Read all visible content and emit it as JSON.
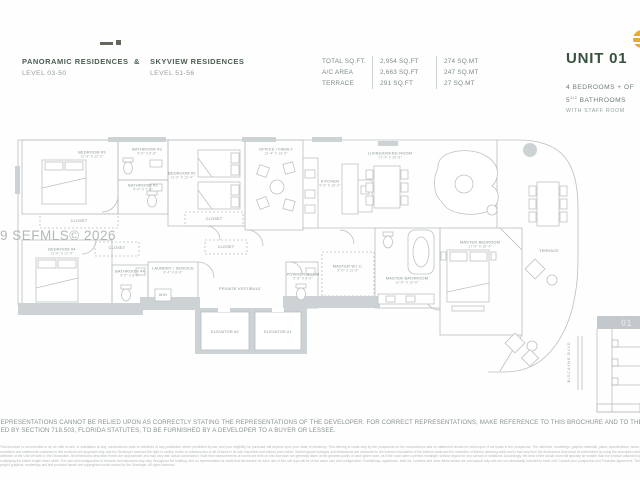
{
  "header": {
    "left": {
      "title1": "PANORAMIC RESIDENCES",
      "amp": "&",
      "title2": "SKYVIEW RESIDENCES",
      "level1": "LEVEL 03-50",
      "level2": "LEVEL 51-56"
    },
    "area_table": {
      "rows": [
        {
          "label": "TOTAL SQ.FT.",
          "sqft": "2,954 SQ.FT",
          "sqmt": "274 SQ.MT"
        },
        {
          "label": "A/C AREA",
          "sqft": "2,663 SQ.FT",
          "sqmt": "247 SQ.MT"
        },
        {
          "label": "TERRACE",
          "sqft": "291 SQ.FT",
          "sqmt": "27 SQ.MT"
        }
      ]
    },
    "unit": {
      "title": "UNIT 01",
      "bedrooms": "4 BEDROOMS + OF",
      "bath_number": "5",
      "bath_fraction": "1/2",
      "bath_label": " BATHROOMS",
      "staff": "WITH STAFF ROOM"
    }
  },
  "watermark": "49 SEFMLS© 2026",
  "plan": {
    "rooms": [
      {
        "name": "BEDROOM #3",
        "dims": "11'-4″ x 12'-0″"
      },
      {
        "name": "BATHROOM #3",
        "dims": "5'-0″ x 8'-6″"
      },
      {
        "name": "CLOSET"
      },
      {
        "name": "BATHROOM #2",
        "dims": "5'-0″ x 7'-6″"
      },
      {
        "name": "BEDROOM #2",
        "dims": "11'-0″ x 12'-4″"
      },
      {
        "name": "CLOSET"
      },
      {
        "name": "OFFICE / FAMILY",
        "dims": "12'-4″ x 13'-6″"
      },
      {
        "name": "KITCHEN",
        "dims": "9'-6″ x 16'-0″"
      },
      {
        "name": "LIVING/DINING ROOM",
        "dims": "17'-4″ x 20'-6″"
      },
      {
        "name": "BEDROOM #4",
        "dims": "11'-0″ x 12'-0″"
      },
      {
        "name": "CLOSET"
      },
      {
        "name": "BATHROOM #4",
        "dims": "5'-0″ x 8'-0″"
      },
      {
        "name": "LAUNDRY / SERVICE",
        "dims": "6'-4″ x 8'-6″"
      },
      {
        "name": "CLOSET"
      },
      {
        "name": "PRIVATE VESTIBULE"
      },
      {
        "name": "POWDER ROOM",
        "dims": "5'-6″ x 6'-0″"
      },
      {
        "name": "MASTER W.I.C.",
        "dims": "8'-6″ x 11'-0″"
      },
      {
        "name": "MASTER BATHROOM",
        "dims": "11'-6″ x 10'-6″"
      },
      {
        "name": "MASTER BEDROOM",
        "dims": "17'-0″ x 16'-4″"
      },
      {
        "name": "ELEVATOR #2"
      },
      {
        "name": "ELEVATOR #1"
      },
      {
        "name": "TERRACE"
      },
      {
        "name": "W/D"
      }
    ],
    "labels": {
      "street": "BISCAYNE BLVD",
      "keyplan_unit": "01"
    }
  },
  "footer": {
    "line1": "REPRESENTATIONS CANNOT BE RELIED UPON AS CORRECTLY STATING THE REPRESENTATIONS OF THE DEVELOPER. FOR CORRECT REPRESENTATIONS, MAKE REFERENCE TO THIS BROCHURE AND TO THE DOC",
    "line2": "RED BY SECTION 718.503, FLORIDA STATUTES, TO BE FURNISHED BY A DEVELOPER TO A BUYER OR LESSEE.",
    "fine_print": "This brochure is not intended to be an offer to sell, or solicitation to buy, condominium units to residents of any jurisdiction where prohibited by law, and your eligibility for purchase will depend upon your state of residency. This offering is made only by the prospectus for the condominium and no statement should be relied upon if not made in the prospectus. The sketches, renderings, graphic materials, plans, specifications, terms, conditions and statements contained in this brochure are proposed only, and the Developer reserves the right to modify, revise or withdraw any or all of same in its sole discretion and without prior notice. Stated square footages and dimensions are measured to the exterior boundaries of the exterior walls and the centerline of interior demising walls and in fact vary from the dimensions that would be determined by using the description and definition of the Unit set forth in the Declaration. All dimensions described herein are approximate and may vary with actual construction. Note that measurements of rooms set forth on this floor plan are generally taken at the greatest points of each given room, as if the room were a perfect rectangle, without regard for any cutouts or variations. Accordingly, the area of the actual room will typically be smaller than the product obtained by multiplying the stated length times width. The size and configuration of terraces and balconies may vary throughout the building, and no representation is made that the terrace for each unit of this unit type will be of the same size and configuration. Furnishings, appliances, built-ins, counters and other items shown are conceptual only and are not necessarily included in each unit. Consult your prospectus and Purchase Agreement. The project graphics, renderings and text provided herein are copyrighted works owned by the Developer. All rights reserved."
  },
  "colors": {
    "accent_green": "#37503f",
    "logo_orange": "#e9a83e",
    "plan_line": "#b9bfc2",
    "wall_fill": "#cdd2d5"
  }
}
